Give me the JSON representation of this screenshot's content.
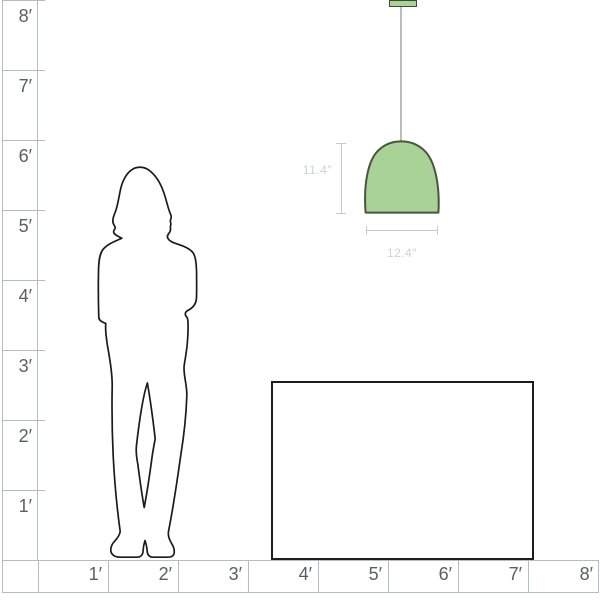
{
  "scale_diagram": {
    "left_ruler": {
      "labels": [
        "8′",
        "7′",
        "6′",
        "5′",
        "4′",
        "3′",
        "2′",
        "1′"
      ]
    },
    "bottom_ruler": {
      "labels": [
        "1′",
        "2′",
        "3′",
        "4′",
        "5′",
        "6′",
        "7′",
        "8′"
      ]
    },
    "pendant": {
      "height_label": "11.4″",
      "width_label": "12.4″"
    },
    "colors": {
      "ruler_line": "#b4bdc3",
      "ruler_text": "#596064",
      "dim_line": "#c6cacc",
      "dim_text": "#ced2d4",
      "shade": "#a9d297",
      "shade_outline": "#49553e",
      "canopy_outline": "#3e4a37",
      "cord": "#bcbcb9",
      "silhouette": "#1b1b1b",
      "table_border": "#1d1d1d"
    }
  }
}
